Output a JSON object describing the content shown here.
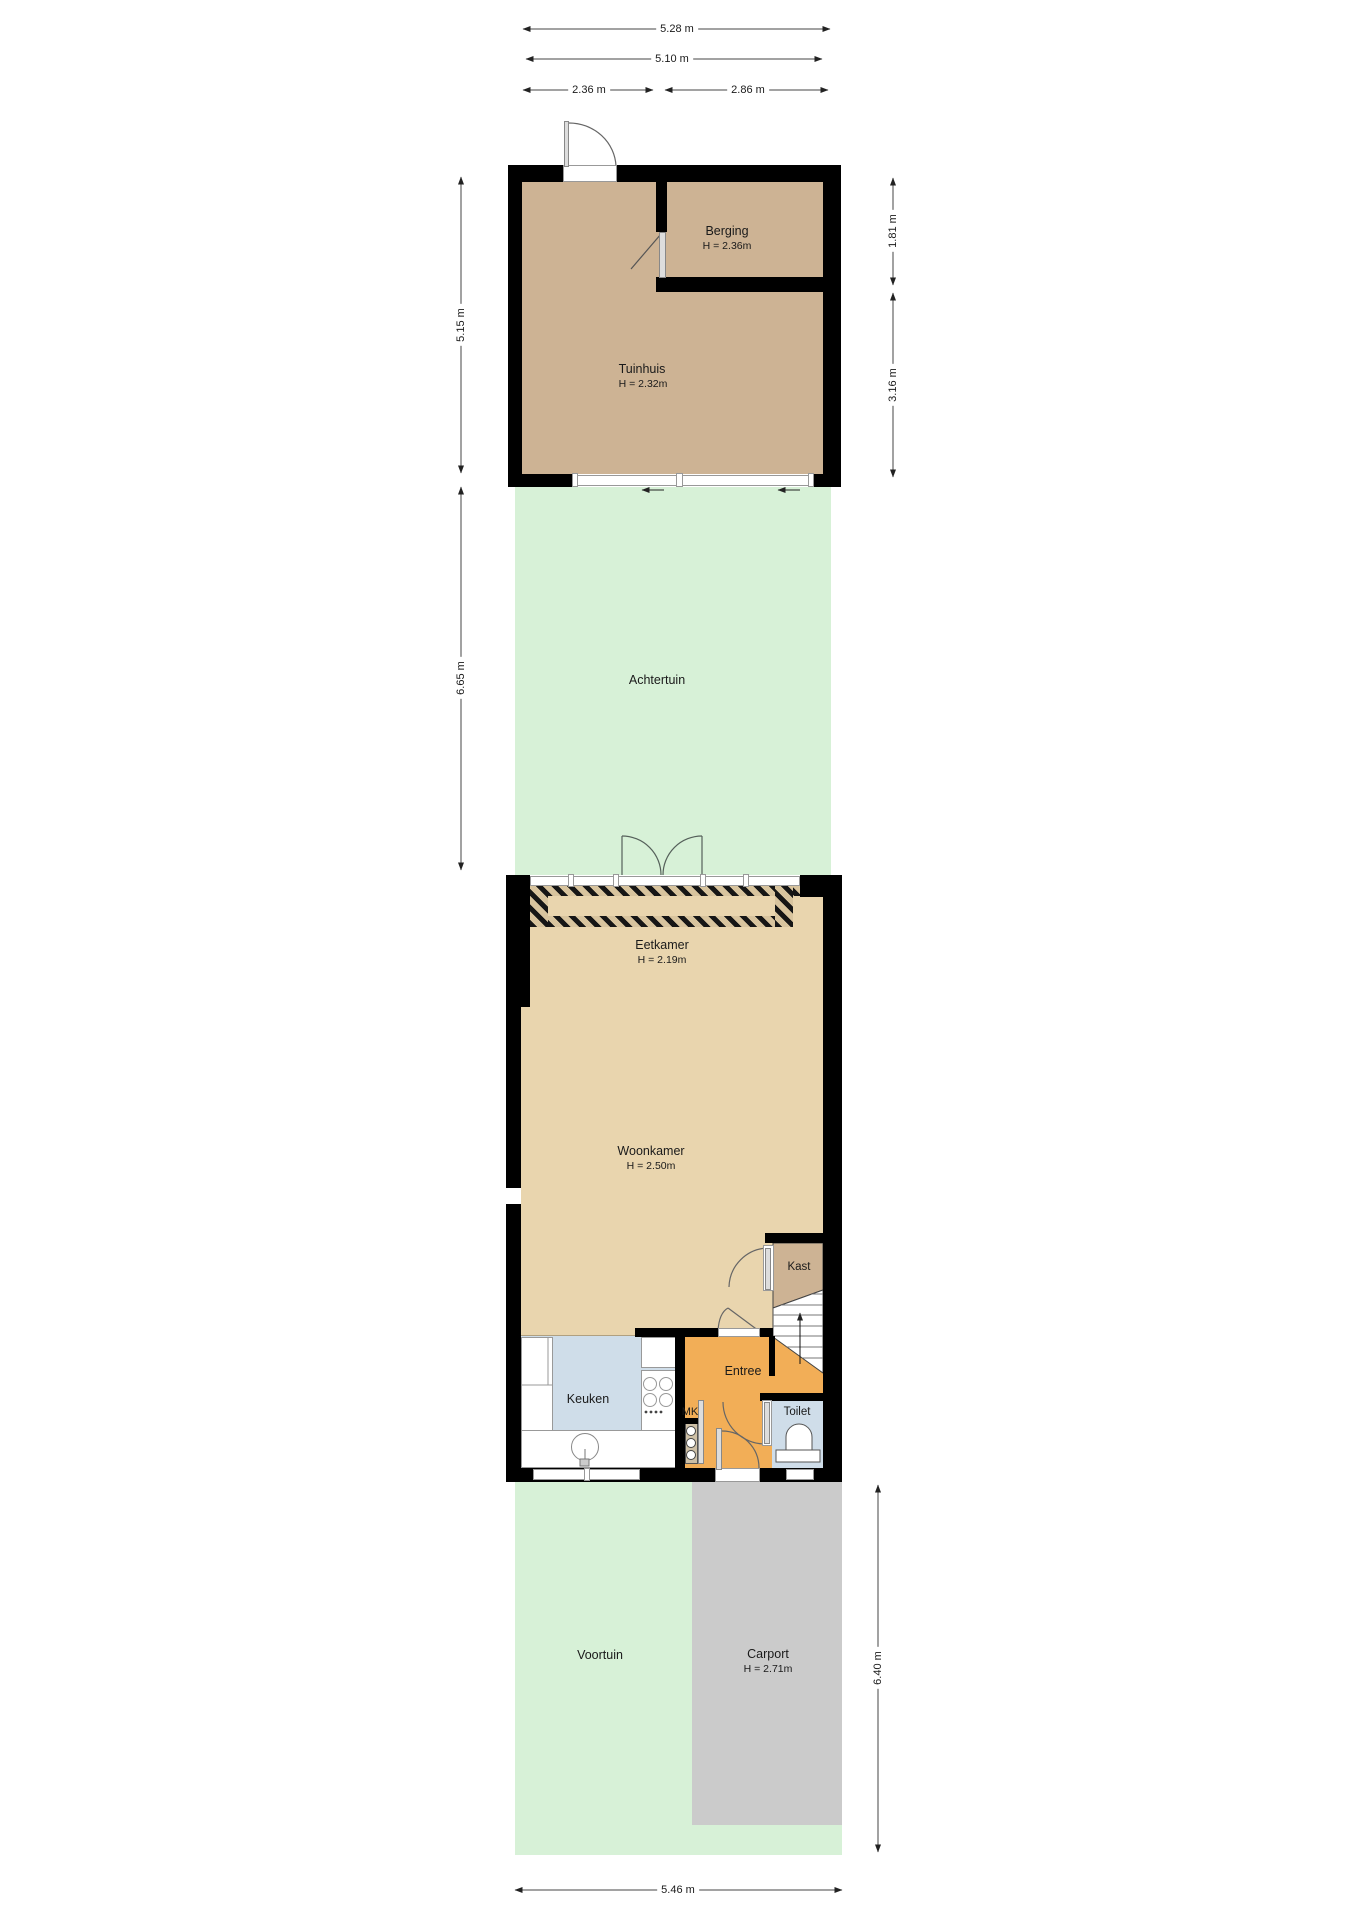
{
  "rooms": {
    "berging": {
      "name": "Berging",
      "height": "H = 2.36m"
    },
    "tuinhuis": {
      "name": "Tuinhuis",
      "height": "H = 2.32m"
    },
    "achtertuin": {
      "name": "Achtertuin"
    },
    "eetkamer": {
      "name": "Eetkamer",
      "height": "H = 2.19m"
    },
    "woonkamer": {
      "name": "Woonkamer",
      "height": "H = 2.50m"
    },
    "kast": {
      "name": "Kast"
    },
    "entree": {
      "name": "Entree"
    },
    "keuken": {
      "name": "Keuken"
    },
    "mk": {
      "name": "MK"
    },
    "toilet": {
      "name": "Toilet"
    },
    "voortuin": {
      "name": "Voortuin"
    },
    "carport": {
      "name": "Carport",
      "height": "H = 2.71m"
    }
  },
  "dimensions": {
    "top_outer_width": "5.28 m",
    "top_inner_width": "5.10 m",
    "tuinhuis_width": "2.36 m",
    "berging_width": "2.86 m",
    "tuinhuis_depth": "5.15 m",
    "achtertuin_depth": "6.65 m",
    "berging_depth": "1.81 m",
    "tuinhuis_lower_depth": "3.16 m",
    "voortuin_depth": "6.40 m",
    "plot_width": "5.46 m"
  },
  "colors": {
    "wall": "#000000",
    "outbuilding_floor": "#cdb394",
    "house_floor": "#e9d5ae",
    "entree_floor": "#f2ae57",
    "wet_room_floor": "#cfdde9",
    "garden": "#d7f1d7",
    "carport": "#cbcbcb",
    "dimension_line": "#444444"
  }
}
